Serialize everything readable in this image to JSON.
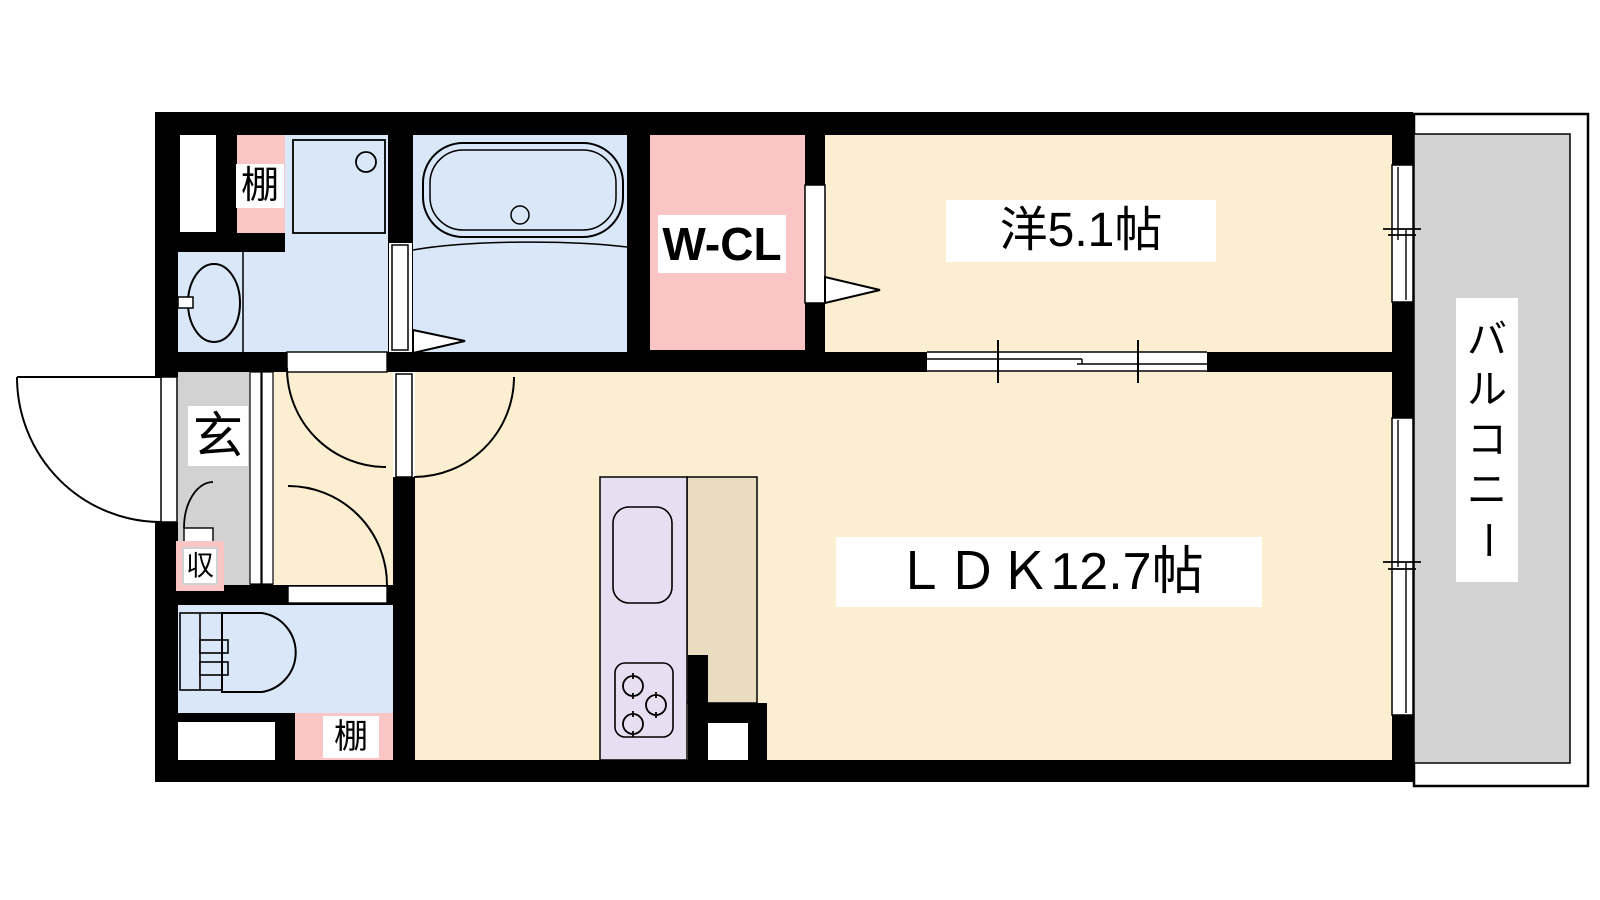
{
  "plan": {
    "type": "apartment-floorplan",
    "labels": {
      "bedroom": "洋5.1帖",
      "ldk": "ＬＤＫ12.7帖",
      "walk_in_closet": "W-CL",
      "balcony": "バルコニー",
      "entrance": "玄",
      "entrance_storage": "収",
      "shelf_top": "棚",
      "shelf_bottom": "棚"
    },
    "colors": {
      "wall": "#000000",
      "room_floor_cream": "#fcefd1",
      "wet_area_blue": "#d9e7f8",
      "closet_pink": "#f9c5c5",
      "entrance_gray": "#d2d2d2",
      "balcony_gray": "#d3d3d3",
      "kitchen_counter_lavender": "#e7def2",
      "kitchen_floor_beige": "#e9dcc0",
      "fixture_white": "#ffffff"
    },
    "fixtures": [
      "bathtub",
      "washbasin",
      "washing-machine-pan",
      "toilet",
      "kitchen-sink",
      "gas-stove-3-burner",
      "entrance-swing-door",
      "interior-swing-doors",
      "sliding-door",
      "sliding-windows",
      "service-shaft"
    ]
  }
}
